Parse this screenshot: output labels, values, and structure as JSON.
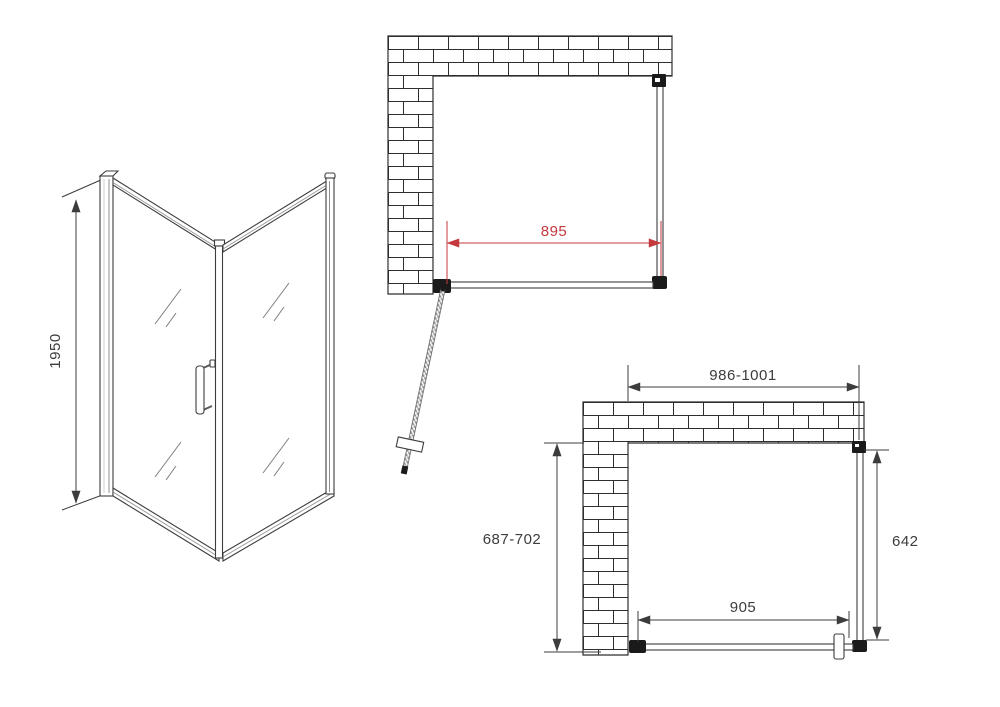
{
  "drawing": {
    "background": "#ffffff",
    "line_color": "#3c3c3c",
    "red_color": "#c4393e",
    "isometric": {
      "height": "1950"
    },
    "plan_open": {
      "door_opening_width": "895"
    },
    "plan_closed": {
      "top_width": "986-1001",
      "left_depth": "687-702",
      "right_depth": "642",
      "bottom_width": "905"
    }
  }
}
